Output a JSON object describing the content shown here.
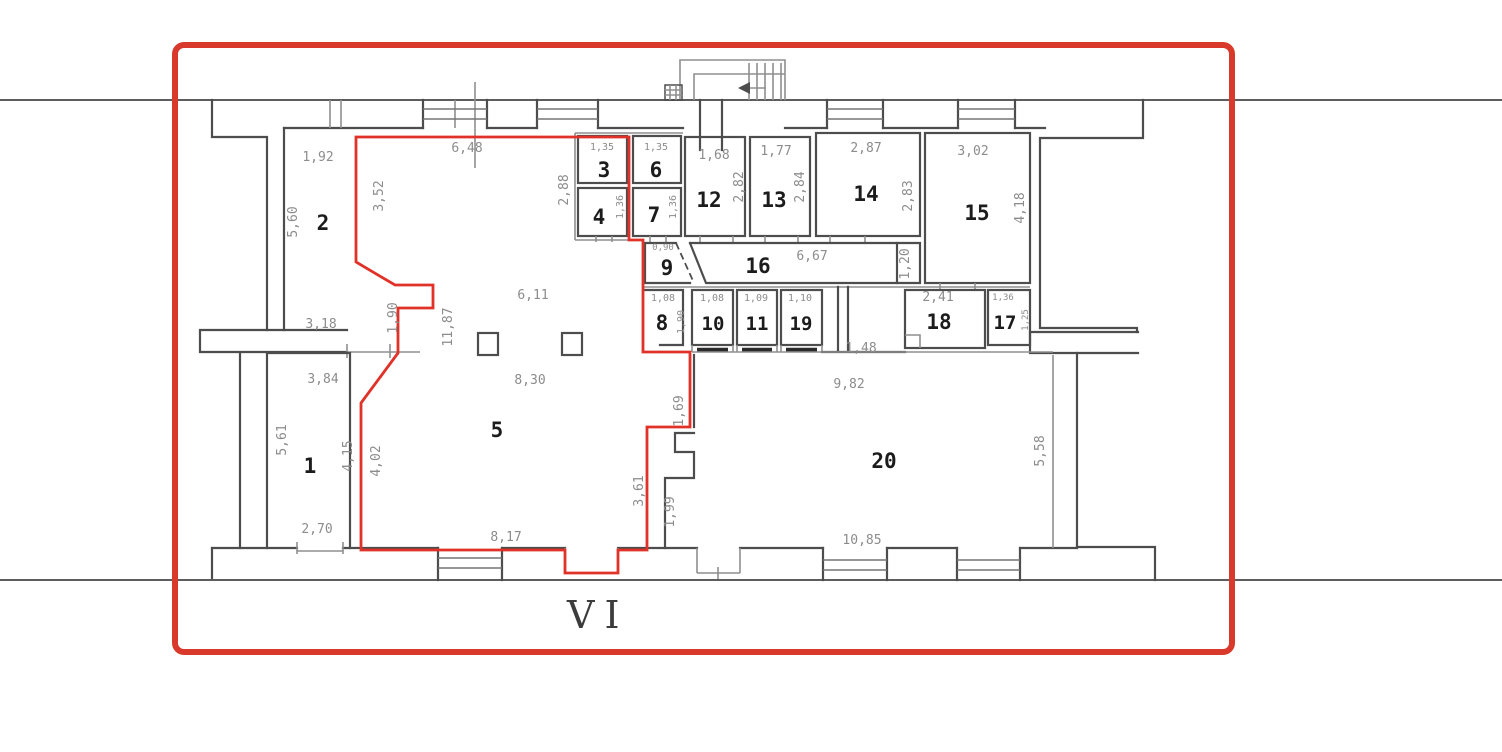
{
  "colors": {
    "highlight_red": "#e03228",
    "border_red": "#d9392b",
    "wall_dark": "#4d4d4d",
    "wall_gray": "#8f8f8f",
    "dim_text": "#8c8c8c",
    "room_text": "#1c1c1c"
  },
  "plan": {
    "section_label": "VI",
    "room_numbers": {
      "r1": "1",
      "r2": "2",
      "r3": "3",
      "r4": "4",
      "r5": "5",
      "r6": "6",
      "r7": "7",
      "r8": "8",
      "r9": "9",
      "r10": "10",
      "r11": "11",
      "r12": "12",
      "r13": "13",
      "r14": "14",
      "r15": "15",
      "r16": "16",
      "r17": "17",
      "r18": "18",
      "r19": "19",
      "r20": "20"
    },
    "dims": {
      "r2_top": "1,92",
      "r2_left": "5,60",
      "r2_bottom": "3,18",
      "r5_top": "6,48",
      "r5_upper_left": "3,52",
      "r5_jog": "1,90",
      "r5_left_long": "11,87",
      "r5_mid": "6,11",
      "r5_center": "8,30",
      "r5_left": "4,02",
      "r5_bottom": "8,17",
      "r5_right": "3,61",
      "r1_top": "3,84",
      "r1_left": "5,61",
      "r1_right": "4,15",
      "r1_bottom": "2,70",
      "r3_top": "1,35",
      "r6_top": "1,35",
      "r34_left": "2,88",
      "r4_right": "1,36",
      "r7_right": "1,36",
      "r12_top": "1,68",
      "r12_right": "2,82",
      "r13_top": "1,77",
      "r13_right": "2,84",
      "r14_top": "2,87",
      "r14_right": "2,83",
      "r15_top": "3,02",
      "r15_right": "4,18",
      "r9_top": "0,90",
      "r16_width": "6,67",
      "r16_right": "1,20",
      "r8_top": "1,08",
      "r8_right": "1,90",
      "r10_top": "1,08",
      "r11_top": "1,09",
      "r19_top": "1,10",
      "r18_top": "2,41",
      "r17_top": "1,36",
      "r17_right": "1,25",
      "hall_width": "1,48",
      "r20_top": "9,82",
      "r20_niche": "1,69",
      "r20_left": "1,99",
      "r20_bottom": "10,85",
      "r20_right": "5,58"
    }
  }
}
